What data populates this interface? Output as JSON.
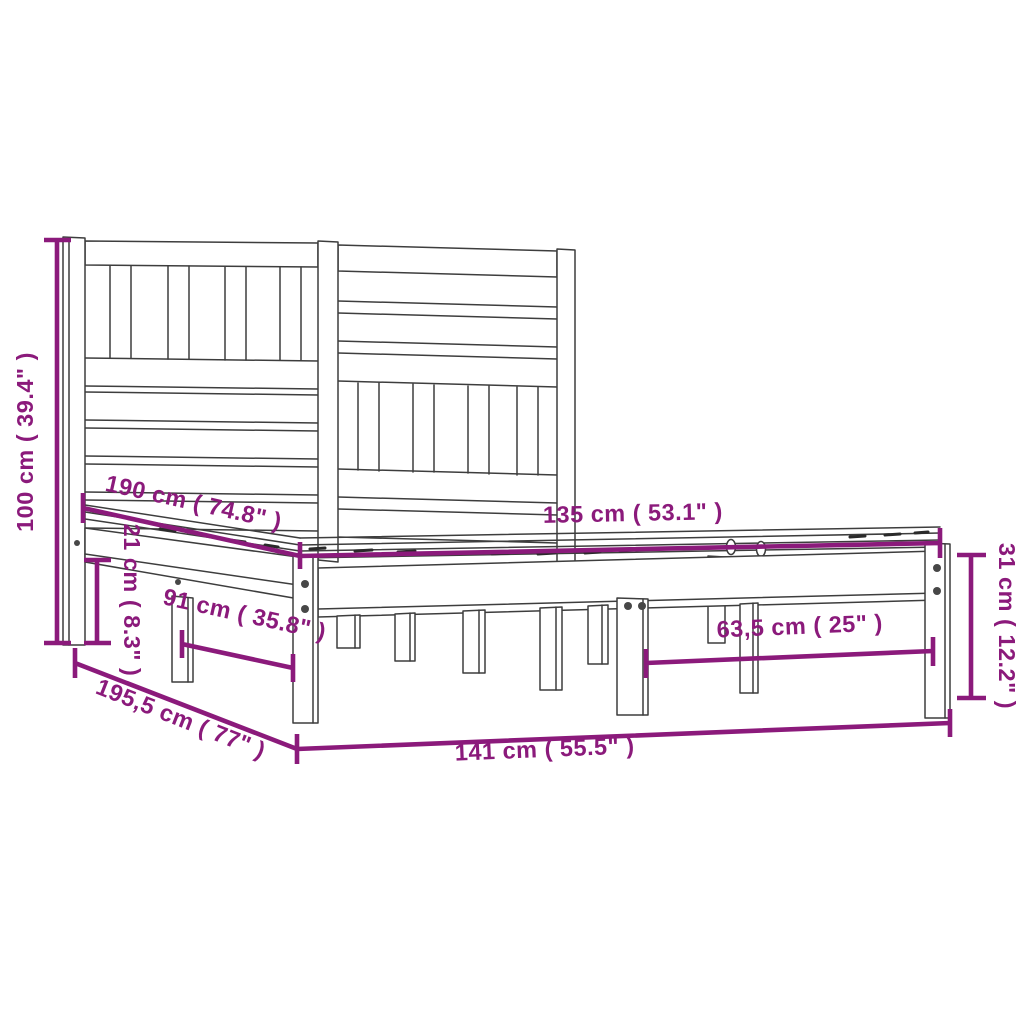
{
  "diagram": {
    "type": "product-dimension-diagram",
    "product": "bed-frame-with-slatted-headboard",
    "background_color": "#ffffff",
    "accent_color": "#8B1A7B",
    "line_color": "#3d3d3d",
    "dimensions": [
      {
        "id": "height-left",
        "label": "100 cm ( 39.4\" )",
        "orientation": "vertical"
      },
      {
        "id": "side-rail-height",
        "label": "21 cm ( 8.3\" )",
        "orientation": "vertical"
      },
      {
        "id": "mattress-length",
        "label": "190 cm ( 74.8\" )",
        "orientation": "diagonal"
      },
      {
        "id": "mattress-width",
        "label": "135 cm ( 53.1\" )",
        "orientation": "horizontal"
      },
      {
        "id": "leg-spacing-length",
        "label": "91 cm ( 35.8\" )",
        "orientation": "diagonal"
      },
      {
        "id": "leg-spacing-width",
        "label": "63,5 cm ( 25\" )",
        "orientation": "horizontal"
      },
      {
        "id": "frame-height-right",
        "label": "31 cm ( 12.2\" )",
        "orientation": "vertical"
      },
      {
        "id": "total-length",
        "label": "195,5 cm ( 77\" )",
        "orientation": "diagonal"
      },
      {
        "id": "total-width",
        "label": "141 cm ( 55.5\" )",
        "orientation": "horizontal"
      }
    ]
  }
}
